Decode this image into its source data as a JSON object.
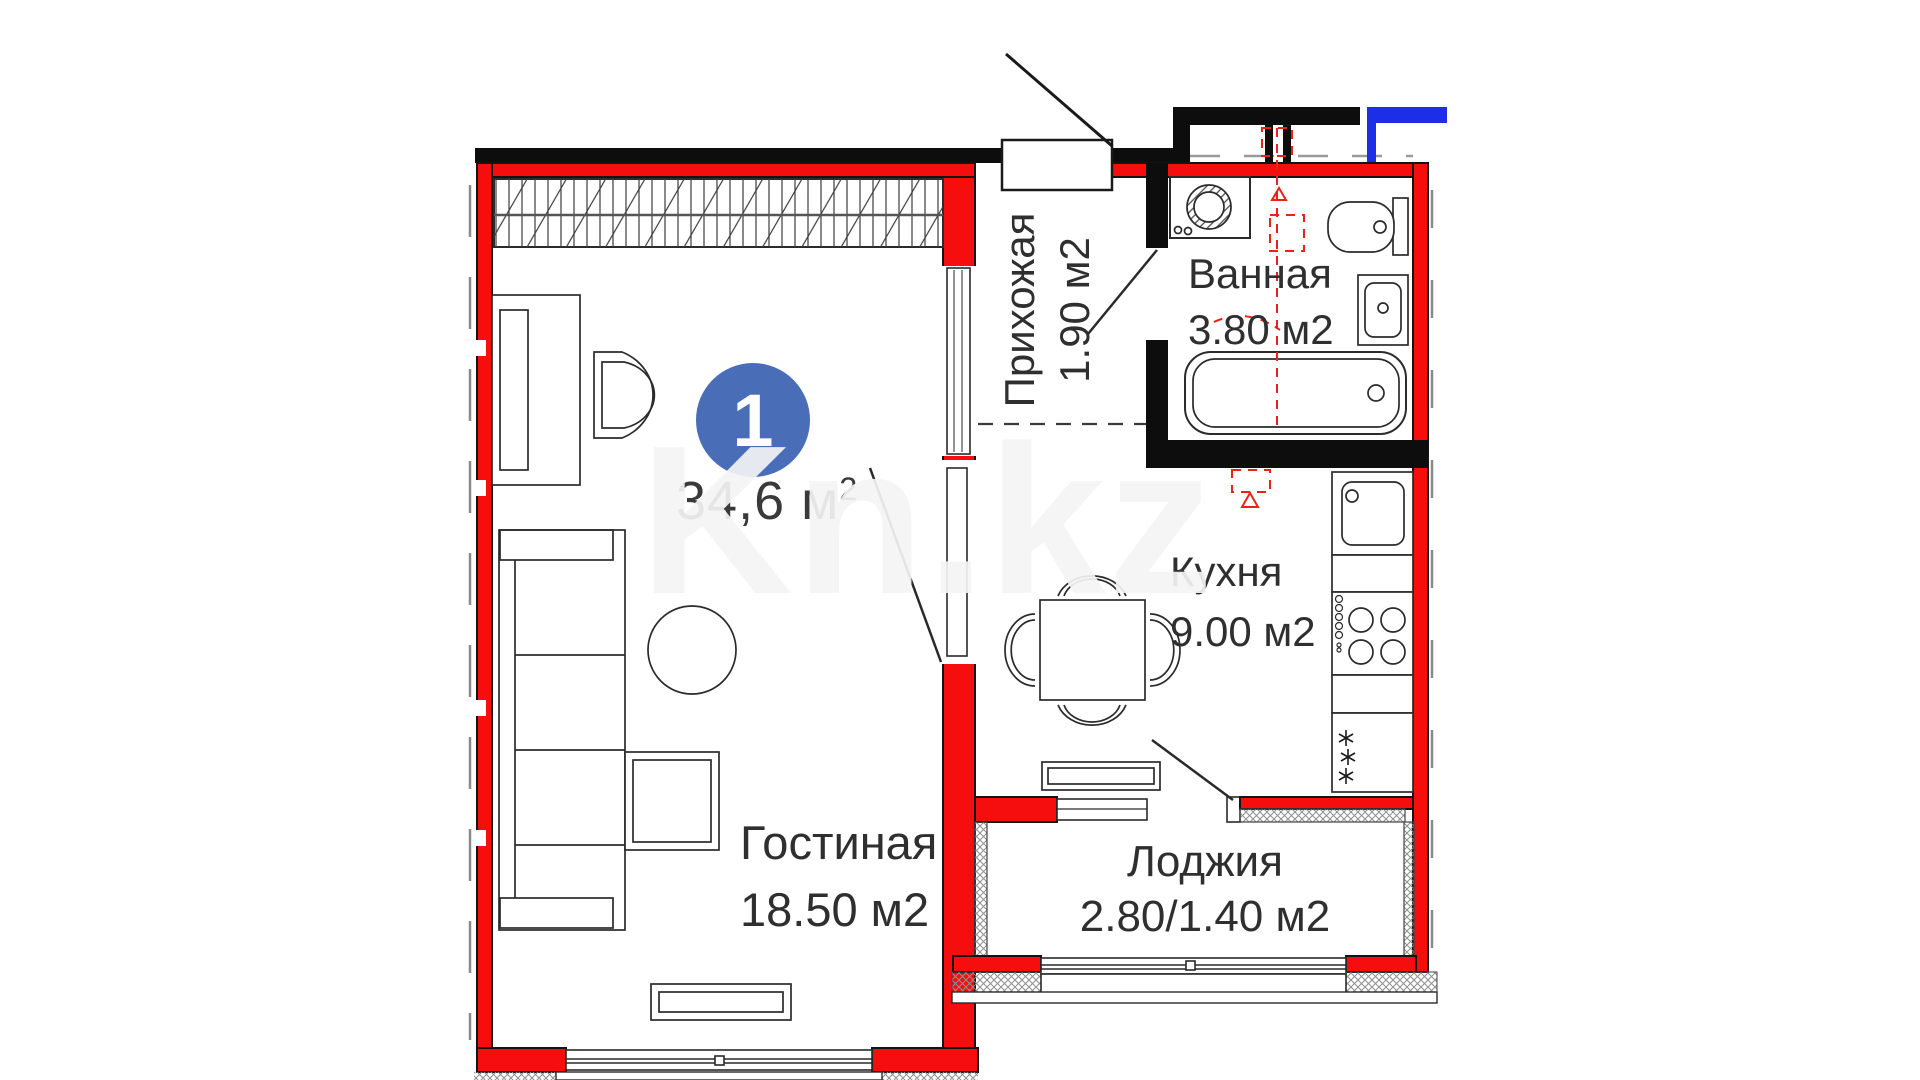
{
  "plan": {
    "badge": {
      "number": "1",
      "color": "#4a6db8"
    },
    "total_area": {
      "value": "34,6",
      "unit": " м",
      "sup": "2"
    },
    "rooms": {
      "living": {
        "name": "Гостиная",
        "area": "18.50 м2"
      },
      "hallway": {
        "name": "Прихожая",
        "area": "1.90 м2"
      },
      "bathroom": {
        "name": "Ванная",
        "area": "3.80 м2"
      },
      "kitchen": {
        "name": "Кухня",
        "area": "9.00 м2",
        "freezer_marks": "✳\n✳\n✳"
      },
      "loggia": {
        "name": "Лоджия",
        "area": "2.80/1.40 м2"
      }
    },
    "watermark": "Kn.kz",
    "colors": {
      "wall_red": "#f60d0d",
      "wall_black": "#0d0d0d",
      "boundary_blue": "#1c2ee8",
      "badge_blue": "#4a6db8",
      "riser_dashed_red": "#e8241a"
    }
  }
}
